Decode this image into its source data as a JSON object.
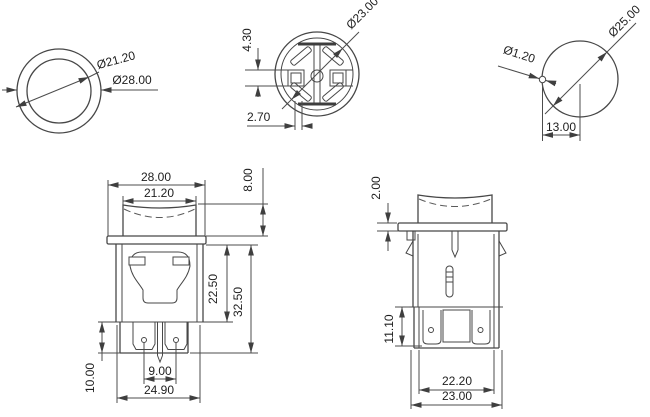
{
  "drawing": {
    "title": "Round push button switch dimensional drawing",
    "background": "#ffffff",
    "line_color": "#474747",
    "text_color": "#1e1e1e"
  },
  "views": {
    "bezel": {
      "inner_dia": "Ø21.20",
      "outer_dia": "Ø28.00"
    },
    "bottom": {
      "dia": "Ø23.00",
      "terminal_h": "4.30",
      "rib_w": "2.70"
    },
    "cutout": {
      "hole_dia": "Ø25.00",
      "notch_dia": "Ø1.20",
      "offset": "13.00"
    },
    "front": {
      "flange_w": "28.00",
      "cap_w": "21.20",
      "cap_h": "8.00",
      "body_h": "22.50",
      "total_h": "32.50",
      "housing_h": "10.00",
      "pin_pitch": "9.00",
      "bottom_w": "24.90"
    },
    "side": {
      "flange_t": "2.00",
      "terminal_h": "11.10",
      "housing_w": "22.20",
      "body_w": "23.00"
    }
  }
}
